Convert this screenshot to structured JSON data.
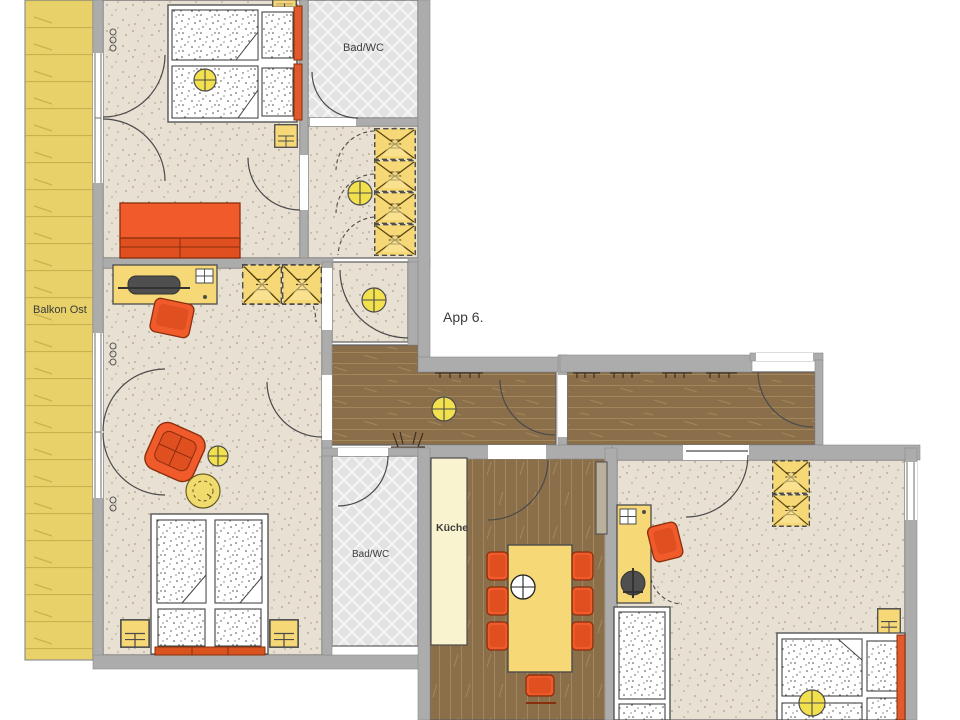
{
  "title": "App 6.",
  "labels": {
    "balcony": "Balkon Ost",
    "bath_top": "Bad/WC",
    "bath_bottom": "Bad/WC",
    "apartment": "App 6.",
    "kitchen": "Küche"
  },
  "colors": {
    "background": "#ffffff",
    "wall": "#acacac",
    "wall_edge": "#5f5f5f",
    "floor_beige": "#e7e0d3",
    "floor_wood": "#8b6f4b",
    "floor_tile": "#e3e3e3",
    "balcony_yellow": "#e8d169",
    "furniture_yellow": "#f6d877",
    "furniture_orange": "#f15b2b",
    "lamp_yellow": "#f2e14d",
    "counter_cream": "#faf3cf"
  },
  "rooms": [
    {
      "name": "balcony-east",
      "label": "Balkon Ost",
      "floor": "wood-deck"
    },
    {
      "name": "bedroom-top-left",
      "floor": "carpet-beige",
      "furniture": [
        "twin-bed",
        "pillows",
        "bed-lamp",
        "nightstand",
        "nightstand",
        "sofa",
        "balcony-door"
      ]
    },
    {
      "name": "bath-wc-top",
      "label": "Bad/WC",
      "floor": "tile"
    },
    {
      "name": "closet-hall-top",
      "floor": "carpet-beige",
      "furniture": [
        "wardrobe",
        "ceiling-lamp"
      ]
    },
    {
      "name": "living-sleeping-room",
      "floor": "carpet-beige",
      "furniture": [
        "desk",
        "computer",
        "desk-chair",
        "wardrobe",
        "armchair",
        "round-table",
        "ceiling-lamp",
        "double-bed",
        "nightstand",
        "nightstand",
        "balcony-door"
      ]
    },
    {
      "name": "vestibule",
      "floor": "carpet-beige",
      "furniture": [
        "ceiling-lamp"
      ]
    },
    {
      "name": "corridor",
      "floor": "wood-plank",
      "furniture": [
        "ceiling-lamp",
        "coat-hooks",
        "shoe-stand",
        "entrance-door"
      ]
    },
    {
      "name": "bath-wc-bottom",
      "label": "Bad/WC",
      "floor": "tile"
    },
    {
      "name": "kitchen-dining",
      "label": "Küche",
      "floor": "wood-plank",
      "furniture": [
        "kitchen-counter",
        "tall-cabinet",
        "dining-table",
        "dining-chairs-7",
        "ceiling-lamp-white"
      ]
    },
    {
      "name": "bedroom-bottom-right",
      "floor": "carpet-beige",
      "furniture": [
        "desk",
        "computer",
        "desk-chair",
        "wardrobe",
        "bed",
        "twin-bed",
        "pillows",
        "bed-lamp",
        "nightstand"
      ]
    }
  ]
}
